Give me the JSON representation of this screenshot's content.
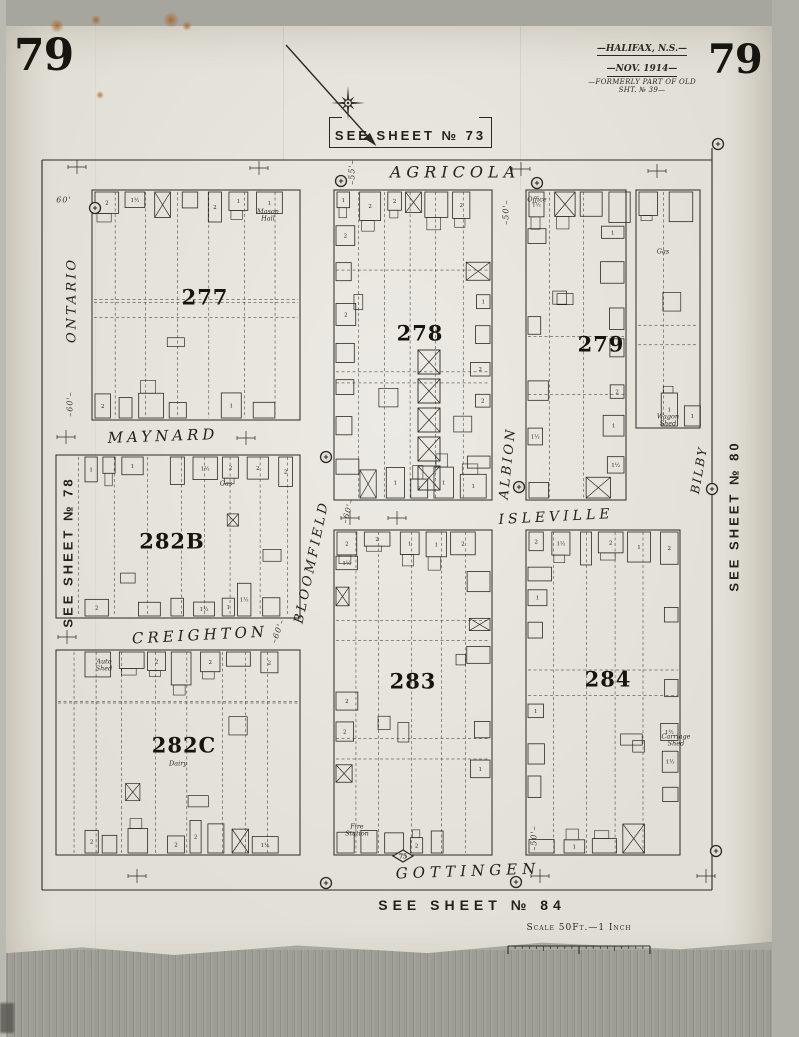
{
  "page": {
    "sheet_number": "79"
  },
  "header": {
    "title": "—HALIFAX, N.S.—",
    "date": "—NOV. 1914—",
    "note": "—FORMERLY PART OF OLD SHT. № 39—"
  },
  "sheet_refs": {
    "top": "SEE SHEET № 73",
    "bottom": "SEE SHEET № 84",
    "left": "SEE SHEET № 78",
    "right": "SEE SHEET № 80"
  },
  "scale": {
    "label": "Scale 50Ft.—1 Inch"
  },
  "compass": {
    "arrow": {
      "x1": 286,
      "y1": 45,
      "x2": 371,
      "y2": 140
    },
    "star": {
      "cx": 348,
      "cy": 103,
      "r_long": 17,
      "r_short": 9
    }
  },
  "map": {
    "ink": "#2b2923",
    "borders": [
      [
        42,
        160,
        712,
        160
      ],
      [
        42,
        160,
        42,
        890
      ],
      [
        712,
        148,
        712,
        890
      ],
      [
        42,
        890,
        712,
        890
      ]
    ],
    "streets": [
      {
        "name": "AGRICOLA",
        "x": 455,
        "y": 172,
        "rot": 0,
        "size": 16,
        "ls": 5
      },
      {
        "name": "ONTARIO",
        "x": 72,
        "y": 300,
        "rot": -90,
        "size": 13,
        "ls": 3
      },
      {
        "name": "MAYNARD",
        "x": 163,
        "y": 436,
        "rot": -2,
        "size": 15,
        "ls": 4
      },
      {
        "name": "BLOOMFIELD",
        "x": 312,
        "y": 562,
        "rot": -78,
        "size": 13,
        "ls": 3
      },
      {
        "name": "ALBION",
        "x": 508,
        "y": 463,
        "rot": -84,
        "size": 13,
        "ls": 3
      },
      {
        "name": "ISLEVILLE",
        "x": 556,
        "y": 517,
        "rot": -3,
        "size": 14,
        "ls": 4
      },
      {
        "name": "BILBY",
        "x": 699,
        "y": 470,
        "rot": -80,
        "size": 12,
        "ls": 2
      },
      {
        "name": "CREIGHTON",
        "x": 200,
        "y": 635,
        "rot": -3,
        "size": 15,
        "ls": 4
      },
      {
        "name": "GOTTINGEN",
        "x": 468,
        "y": 871,
        "rot": -2,
        "size": 15,
        "ls": 5
      }
    ],
    "blocks": [
      {
        "number": "277",
        "x": 92,
        "y": 190,
        "w": 208,
        "h": 230,
        "nx": 205,
        "ny": 297,
        "seed": 11
      },
      {
        "number": "278",
        "x": 334,
        "y": 190,
        "w": 158,
        "h": 310,
        "nx": 420,
        "ny": 333,
        "seed": 22,
        "f": [
          "xcolumn"
        ]
      },
      {
        "number": "279",
        "x": 526,
        "y": 190,
        "w": 100,
        "h": 310,
        "nx": 601,
        "ny": 344,
        "seed": 33
      },
      {
        "number": "",
        "x": 636,
        "y": 190,
        "w": 64,
        "h": 238,
        "seed": 44
      },
      {
        "number": "282B",
        "x": 56,
        "y": 455,
        "w": 244,
        "h": 163,
        "nx": 172,
        "ny": 541,
        "seed": 55,
        "f": [
          "clear_left"
        ]
      },
      {
        "number": "282C",
        "x": 56,
        "y": 650,
        "w": 244,
        "h": 205,
        "nx": 184,
        "ny": 745,
        "seed": 66,
        "f": [
          "clear_left"
        ]
      },
      {
        "number": "283",
        "x": 334,
        "y": 530,
        "w": 158,
        "h": 325,
        "nx": 413,
        "ny": 681,
        "seed": 77
      },
      {
        "number": "284",
        "x": 526,
        "y": 530,
        "w": 154,
        "h": 325,
        "nx": 608,
        "ny": 679,
        "seed": 88
      }
    ],
    "storey_glyphs": [
      "2",
      "2",
      "1",
      "1½"
    ],
    "hydrants": [
      [
        95,
        208
      ],
      [
        341,
        181
      ],
      [
        537,
        183
      ],
      [
        718,
        144
      ],
      [
        326,
        457
      ],
      [
        519,
        487
      ],
      [
        712,
        489
      ],
      [
        326,
        883
      ],
      [
        516,
        882
      ],
      [
        716,
        851
      ]
    ],
    "diamonds": [
      {
        "x": 403,
        "y": 856,
        "label": "75"
      }
    ],
    "ticks": [
      [
        77,
        167
      ],
      [
        259,
        168
      ],
      [
        521,
        169
      ],
      [
        657,
        171
      ],
      [
        66,
        437
      ],
      [
        246,
        438
      ],
      [
        350,
        518
      ],
      [
        397,
        518
      ],
      [
        67,
        637
      ],
      [
        137,
        876
      ],
      [
        540,
        876
      ],
      [
        706,
        876
      ]
    ],
    "annotations": [
      {
        "text": "60'",
        "x": 64,
        "y": 200,
        "rot": 0
      },
      {
        "text": "–55'–",
        "x": 352,
        "y": 172,
        "rot": -90
      },
      {
        "text": "–50'–",
        "x": 506,
        "y": 212,
        "rot": -90
      },
      {
        "text": "–60'–",
        "x": 70,
        "y": 404,
        "rot": -90
      },
      {
        "text": "–60'–",
        "x": 348,
        "y": 511,
        "rot": -75
      },
      {
        "text": "–60'–",
        "x": 278,
        "y": 631,
        "rot": -70
      },
      {
        "text": "–50'–",
        "x": 534,
        "y": 838,
        "rot": -90
      }
    ],
    "building_labels": [
      {
        "lines": [
          "Mason",
          "Hall"
        ],
        "x": 268,
        "y": 216
      },
      {
        "lines": [
          "Office"
        ],
        "x": 537,
        "y": 200
      },
      {
        "lines": [
          "Gas"
        ],
        "x": 663,
        "y": 252
      },
      {
        "lines": [
          "Gas"
        ],
        "x": 226,
        "y": 484
      },
      {
        "lines": [
          "Wagon",
          "Shed"
        ],
        "x": 668,
        "y": 421
      },
      {
        "lines": [
          "Carriage",
          "Shed"
        ],
        "x": 676,
        "y": 741
      },
      {
        "lines": [
          "Dairy"
        ],
        "x": 178,
        "y": 764
      },
      {
        "lines": [
          "Auto",
          "Shed"
        ],
        "x": 104,
        "y": 666
      },
      {
        "lines": [
          "Fire",
          "Station"
        ],
        "x": 357,
        "y": 831
      }
    ]
  },
  "scale_bar": {
    "x1": 508,
    "x2": 650,
    "y": 946
  },
  "stains": [
    [
      57,
      26,
      7
    ],
    [
      96,
      20,
      5
    ],
    [
      171,
      20,
      8
    ],
    [
      187,
      26,
      5
    ],
    [
      100,
      95,
      4
    ]
  ]
}
